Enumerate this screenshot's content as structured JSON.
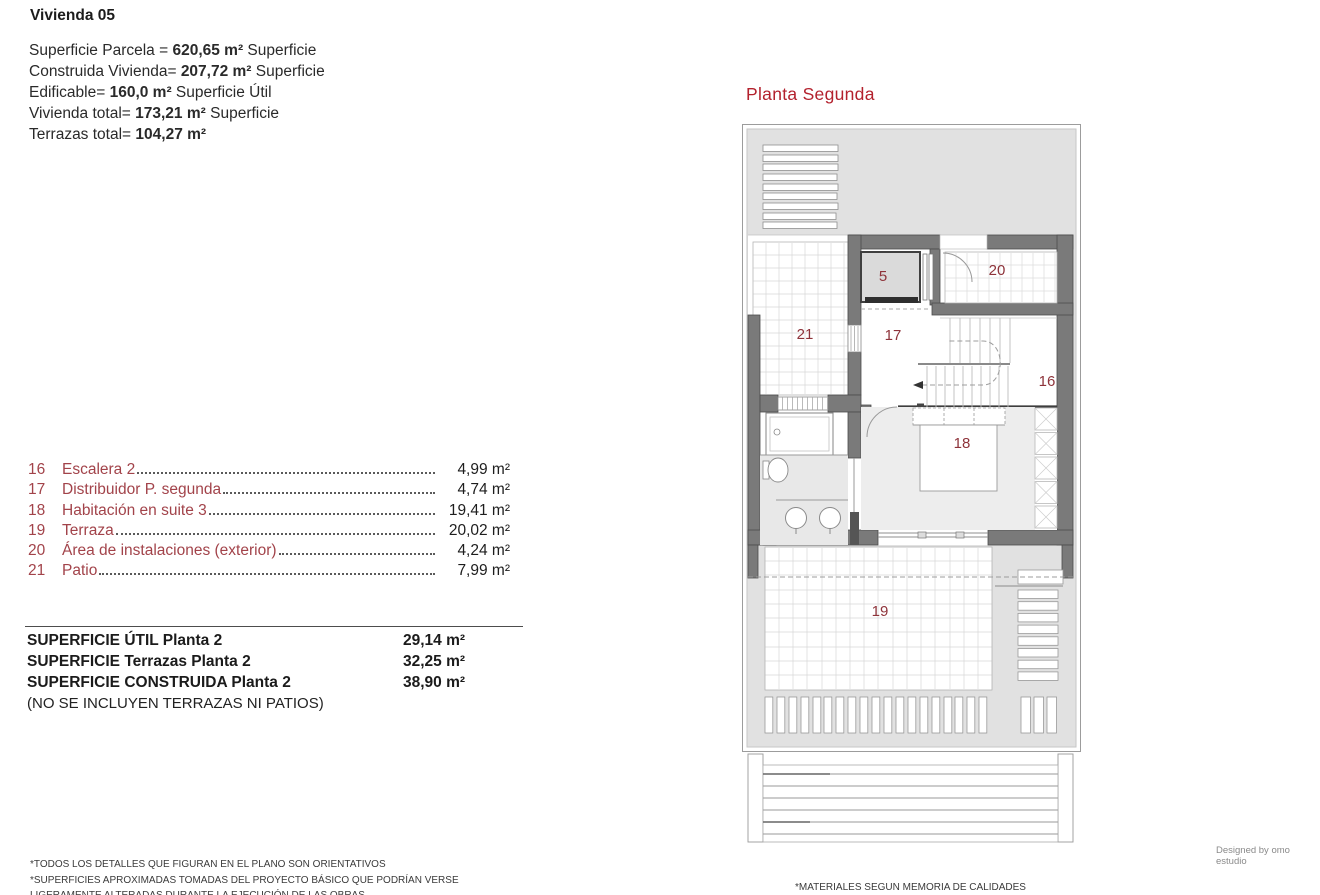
{
  "header": {
    "title": "Vivienda 05"
  },
  "area_summary": {
    "lines": [
      {
        "pre": "Superficie Parcela = ",
        "value": "620,65 m²",
        "post": " Superficie"
      },
      {
        "pre": "Construida Vivienda= ",
        "value": "207,72 m²",
        "post": " Superficie"
      },
      {
        "pre": "Edificable= ",
        "value": "160,0 m²",
        "post": " Superficie Útil"
      },
      {
        "pre": "Vivienda total= ",
        "value": "173,21 m²",
        "post": " Superficie"
      },
      {
        "pre": "Terrazas total= ",
        "value": "104,27 m²",
        "post": ""
      }
    ]
  },
  "room_list": {
    "rows": [
      {
        "num": "16",
        "name": "Escalera 2",
        "area": "4,99 m²"
      },
      {
        "num": "17",
        "name": "Distribuidor P. segunda",
        "area": "4,74 m²"
      },
      {
        "num": "18",
        "name": "Habitación en suite 3",
        "area": "19,41 m²"
      },
      {
        "num": "19",
        "name": "Terraza",
        "area": "20,02 m²"
      },
      {
        "num": "20",
        "name": "Área de instalaciones (exterior)",
        "area": "4,24 m²"
      },
      {
        "num": "21",
        "name": "Patio",
        "area": "7,99 m²"
      }
    ]
  },
  "totals": {
    "rows": [
      {
        "label": "SUPERFICIE ÚTIL Planta 2",
        "value": "29,14 m²"
      },
      {
        "label": "SUPERFICIE Terrazas Planta 2",
        "value": "32,25 m²"
      },
      {
        "label": "SUPERFICIE CONSTRUIDA Planta 2",
        "value": "38,90 m²"
      }
    ],
    "note": "(NO SE INCLUYEN TERRAZAS NI PATIOS)"
  },
  "plan": {
    "title": "Planta Segunda",
    "room_labels": [
      {
        "num": "5"
      },
      {
        "num": "20"
      },
      {
        "num": "21"
      },
      {
        "num": "17"
      },
      {
        "num": "16"
      },
      {
        "num": "18"
      },
      {
        "num": "19"
      }
    ]
  },
  "footnotes": {
    "left": [
      "*TODOS LOS DETALLES QUE FIGURAN EN EL PLANO SON ORIENTATIVOS",
      "*SUPERFICIES APROXIMADAS TOMADAS DEL PROYECTO BÁSICO QUE PODRÍAN VERSE",
      "LIGERAMENTE ALTERADAS DURANTE LA EJECUCIÓN DE LAS OBRAS"
    ],
    "right": "*MATERIALES SEGUN MEMORIA DE CALIDADES"
  },
  "credit": "Designed by omo estudio",
  "colors": {
    "title_red": "#b3212d",
    "label_maroon": "#8e333a",
    "list_maroon": "#a2434a",
    "wall_gray": "#7a7a7a",
    "roof_gray": "#e1e1e1"
  }
}
